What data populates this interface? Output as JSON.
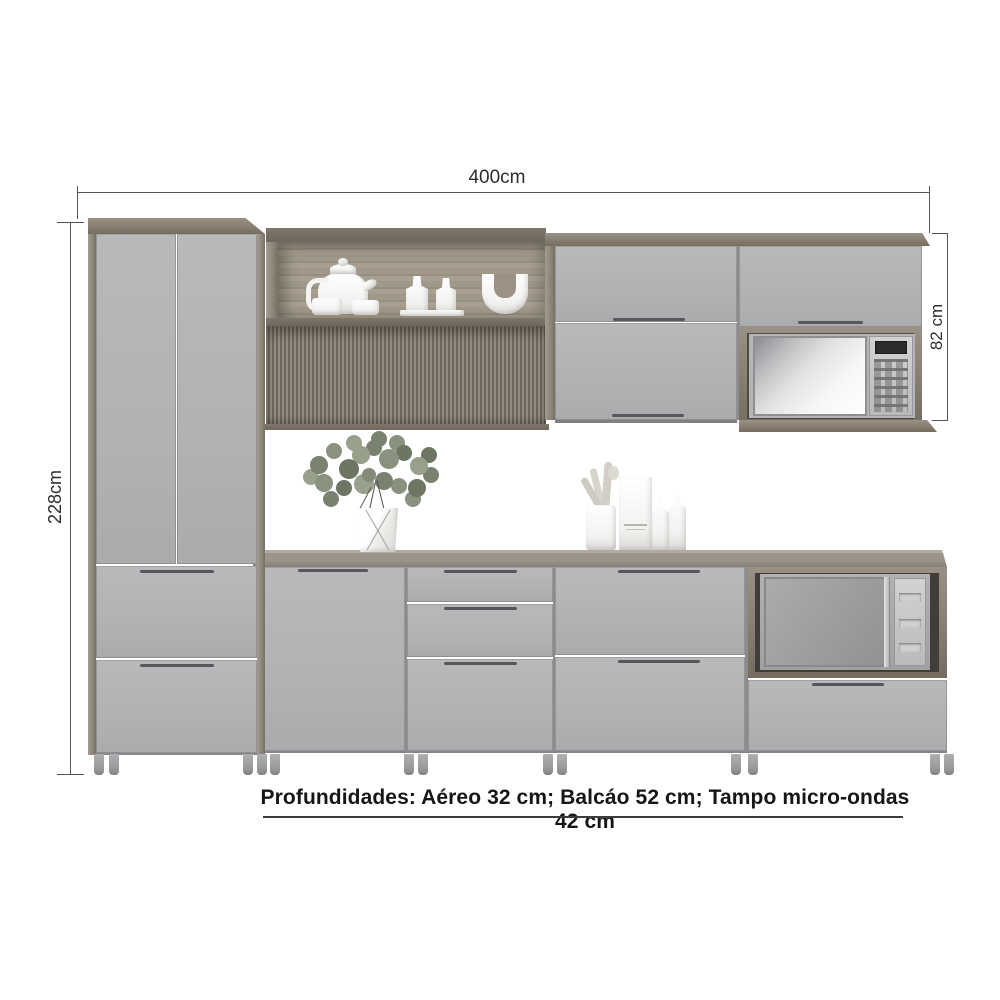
{
  "dimensions": {
    "width_label": "400cm",
    "height_label": "228cm",
    "upper_height_label": "82 cm"
  },
  "note_text": "Profundidades: Aéreo 32 cm; Balcáo 52 cm; Tampo micro-ondas 42 cm",
  "colors": {
    "background": "#ffffff",
    "door_grey": "#b2b4b5",
    "wood": "#8e8578",
    "wood_dark": "#6f675d",
    "countertop": "#9a948b",
    "dimension_line": "#555555",
    "note_text_color": "#161616"
  },
  "objects": {
    "appliances": [
      "upper-microwave",
      "lower-microwave"
    ],
    "decor": [
      "teapot",
      "cups",
      "bottles",
      "u-vase",
      "flower-vase",
      "utensil-holder",
      "package-box",
      "counter-bottles"
    ]
  }
}
